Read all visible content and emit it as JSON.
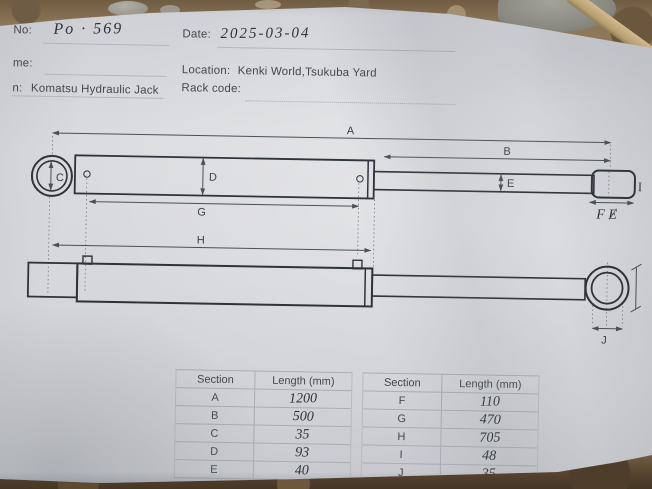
{
  "form": {
    "no_label": "No:",
    "no_value": "Po · 569",
    "date_label": "Date:",
    "date_value": "2025-03-04",
    "name_label": "me:",
    "location_label": "Location:",
    "location_value": "Kenki World,Tsukuba Yard",
    "item_label": "n:",
    "item_value": "Komatsu Hydraulic Jack",
    "rack_label": "Rack code:"
  },
  "drawing": {
    "dim_a": "A",
    "dim_b": "B",
    "dim_c": "C",
    "dim_d": "D",
    "dim_e": "E",
    "dim_f_note": "F Ɇ",
    "dim_g": "G",
    "dim_h": "H",
    "dim_i": "I",
    "dim_j": "J"
  },
  "table": {
    "left": {
      "col_section": "Section",
      "col_length": "Length (mm)",
      "rows": [
        {
          "section": "A",
          "length": "1200"
        },
        {
          "section": "B",
          "length": "500"
        },
        {
          "section": "C",
          "length": "35"
        },
        {
          "section": "D",
          "length": "93"
        },
        {
          "section": "E",
          "length": "40"
        }
      ]
    },
    "right": {
      "col_section": "Section",
      "col_length": "Length (mm)",
      "rows": [
        {
          "section": "F",
          "length": "110"
        },
        {
          "section": "G",
          "length": "470"
        },
        {
          "section": "H",
          "length": "705"
        },
        {
          "section": "I",
          "length": "48"
        },
        {
          "section": "J",
          "length": "35"
        }
      ]
    }
  },
  "colors": {
    "paper": "#d6d7db",
    "printed_ink": "#43474e",
    "hand_ink": "#2e333a",
    "dirt": "#8d7759"
  }
}
